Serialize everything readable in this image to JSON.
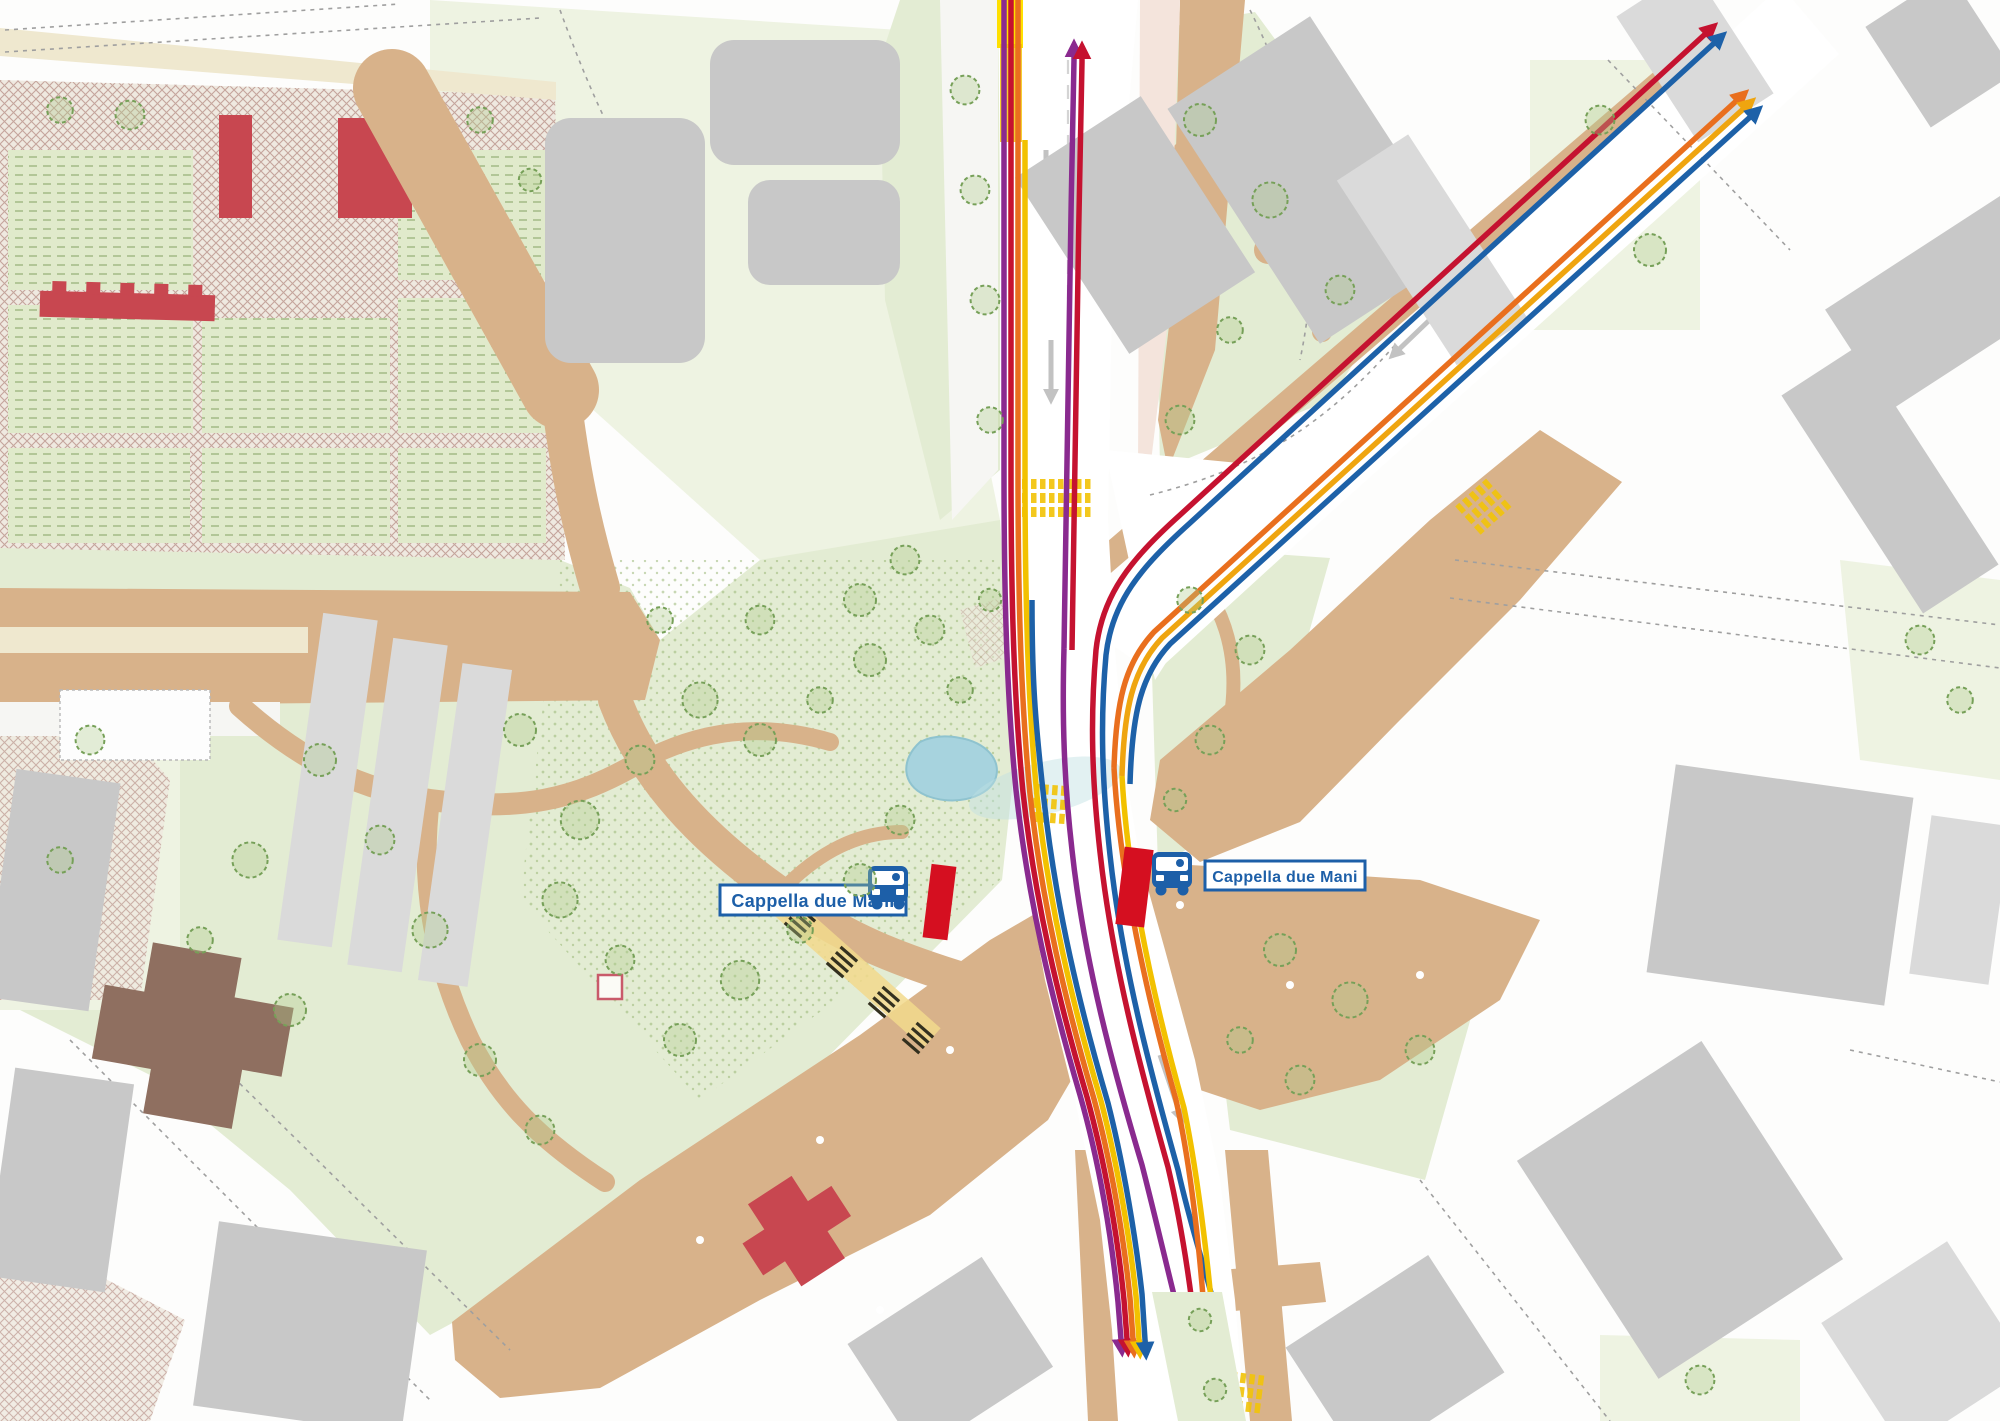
{
  "stops": [
    {
      "id": "west",
      "label": "Cappella due Mani"
    },
    {
      "id": "east",
      "label": "Cappella due Mani"
    }
  ],
  "routes": {
    "purple": {
      "color": "#8a2a8f"
    },
    "red": {
      "color": "#c51230"
    },
    "orange": {
      "color": "#e96f1e"
    },
    "yellow": {
      "color": "#f2c100"
    },
    "amber": {
      "color": "#efa50f"
    },
    "blue": {
      "color": "#1d61a8"
    }
  },
  "palette": {
    "label_blue": "#1d5fa8",
    "bus_icon_blue": "#1d5fa8",
    "platform_red": "#d50f20",
    "stop_marker_yellow": "#ffe000",
    "crosswalk_yellow": "#f2c40c",
    "pond": "#a7d3de",
    "park_green": "#e3ecd3",
    "road_beige": "#d8b28a",
    "building_gray": "#c8c8c8",
    "building_red": "#c84750",
    "building_brown": "#8f6f60",
    "paving_pink": "#f4e4dc",
    "hatch_pink": "#c5a59c"
  }
}
